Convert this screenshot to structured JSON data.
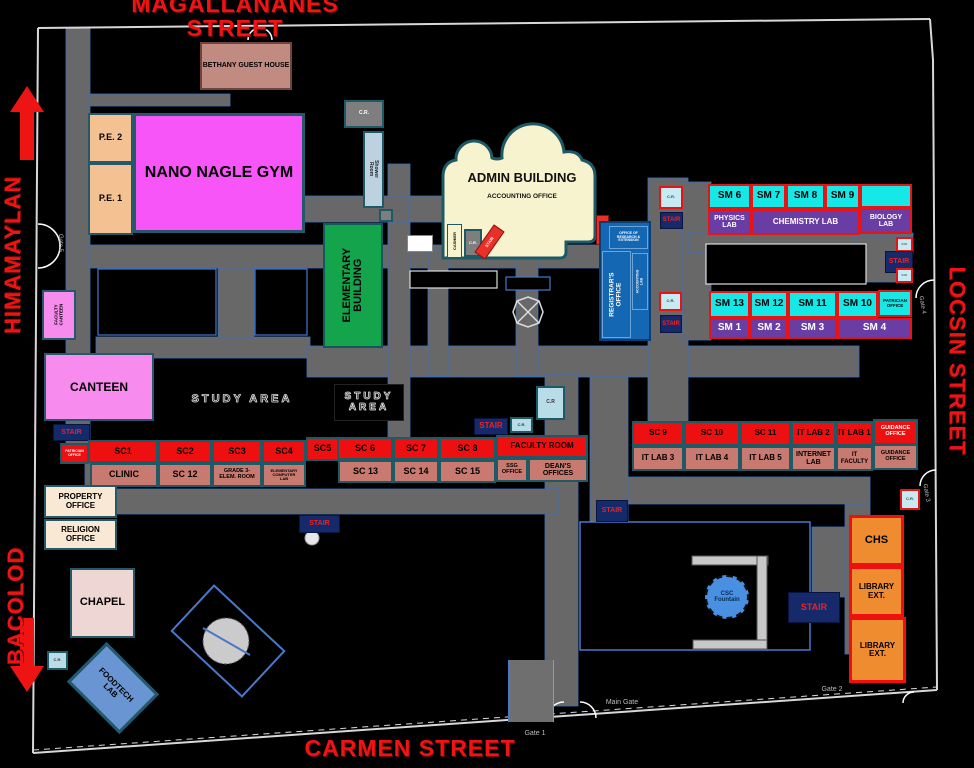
{
  "streets": {
    "top": "MAGALLANANES STREET",
    "left_upper": "HIMAMAYLAN",
    "left_lower": "BACOLOD",
    "right": "LOCSIN STREET",
    "bottom": "CARMEN STREET"
  },
  "colors": {
    "street_text": "#ee1414",
    "room_red": "#ee1010",
    "room_rose": "#c87a70",
    "room_cyan": "#16e8e8",
    "room_purple": "#6a3da5",
    "stair_navy": "#16296b",
    "gym_magenta": "#f855f8",
    "elementary_green": "#14a44c",
    "registrar_blue": "#1467b2",
    "library_orange": "#f08c30",
    "road_gray": "#686868",
    "background": "#000000"
  },
  "rooms": [
    {
      "id": "bethany-guest-house",
      "cls": "brown",
      "x": 200,
      "y": 42,
      "w": 92,
      "h": 48,
      "fs": 7,
      "label": "BETHANY GUEST HOUSE"
    },
    {
      "id": "pe-2",
      "cls": "peach",
      "x": 88,
      "y": 113,
      "w": 45,
      "h": 50,
      "fs": 9,
      "label": "P.E. 2"
    },
    {
      "id": "pe-1",
      "cls": "peach",
      "x": 88,
      "y": 163,
      "w": 45,
      "h": 72,
      "fs": 9,
      "label": "P.E. 1"
    },
    {
      "id": "nano-nagle-gym",
      "cls": "magenta",
      "x": 133,
      "y": 113,
      "w": 172,
      "h": 120,
      "fs": 16,
      "label": "NANO NAGLE GYM"
    },
    {
      "id": "cr-gym",
      "cls": "gray",
      "x": 344,
      "y": 100,
      "w": 40,
      "h": 28,
      "fs": 5,
      "label": "C.R."
    },
    {
      "id": "shower-room",
      "cls": "shower",
      "x": 363,
      "y": 131,
      "w": 21,
      "h": 77,
      "fs": 5,
      "label": "Shower Room",
      "trot": 90
    },
    {
      "id": "utility-box",
      "cls": "gray",
      "x": 379,
      "y": 209,
      "w": 14,
      "h": 13,
      "fs": 3,
      "label": ""
    },
    {
      "id": "elementary-building",
      "cls": "green",
      "x": 323,
      "y": 223,
      "w": 60,
      "h": 125,
      "fs": 11,
      "label": "ELEMENTARY\nBUILDING",
      "trot": -90
    },
    {
      "id": "cashier",
      "cls": "adm2",
      "x": 447,
      "y": 224,
      "w": 15,
      "h": 34,
      "fs": 4,
      "label": "CASHIER",
      "trot": -90
    },
    {
      "id": "cr-admin",
      "cls": "gray",
      "x": 464,
      "y": 229,
      "w": 18,
      "h": 28,
      "fs": 4,
      "label": "C.R."
    },
    {
      "id": "stair-admin",
      "cls": "redstair",
      "x": 483,
      "y": 225,
      "w": 13,
      "h": 34,
      "fs": 4,
      "label": "STAIR",
      "rot": 35,
      "trot": -90
    },
    {
      "id": "white-kiosk",
      "cls": "white",
      "x": 407,
      "y": 235,
      "w": 26,
      "h": 17,
      "fs": 3,
      "label": ""
    },
    {
      "id": "stair-registrar",
      "cls": "redstair",
      "x": 596,
      "y": 215,
      "w": 13,
      "h": 30,
      "fs": 5,
      "label": "STAIR",
      "trot": -90
    },
    {
      "id": "registrar-building",
      "cls": "bluebld",
      "x": 599,
      "y": 221,
      "w": 52,
      "h": 120,
      "fs": 5,
      "label": ""
    },
    {
      "id": "office-research-extension",
      "cls": "blue2",
      "x": 609,
      "y": 226,
      "w": 39,
      "h": 23,
      "fs": 3.5,
      "label": "OFFICE OF\nRESEARCH &\nEXTENSION"
    },
    {
      "id": "registrars-office",
      "cls": "blue2",
      "x": 602,
      "y": 251,
      "w": 29,
      "h": 87,
      "fs": 6.5,
      "label": "REGISTRAR'S\nOFFICE",
      "trot": -90
    },
    {
      "id": "accounting-lab",
      "cls": "blue2",
      "x": 632,
      "y": 253,
      "w": 16,
      "h": 57,
      "fs": 3.5,
      "label": "ACCOUNTING\nLAB",
      "trot": -90
    },
    {
      "id": "cr-sm-upper",
      "cls": "crc",
      "x": 659,
      "y": 186,
      "w": 24,
      "h": 23,
      "fs": 4,
      "label": "C.R."
    },
    {
      "id": "stair-sm-upper",
      "cls": "navy",
      "x": 660,
      "y": 212,
      "w": 23,
      "h": 17,
      "fs": 6,
      "label": "STAIR"
    },
    {
      "id": "sm-6",
      "cls": "cyan",
      "x": 708,
      "y": 184,
      "w": 43,
      "h": 25,
      "fs": 10,
      "label": "SM 6"
    },
    {
      "id": "sm-7",
      "cls": "cyan",
      "x": 751,
      "y": 184,
      "w": 35,
      "h": 25,
      "fs": 10,
      "label": "SM 7"
    },
    {
      "id": "sm-8",
      "cls": "cyan",
      "x": 786,
      "y": 184,
      "w": 39,
      "h": 25,
      "fs": 10,
      "label": "SM 8"
    },
    {
      "id": "sm-9",
      "cls": "cyan",
      "x": 825,
      "y": 184,
      "w": 35,
      "h": 25,
      "fs": 10,
      "label": "SM 9"
    },
    {
      "id": "sm-room-unlabeled",
      "cls": "cyan",
      "x": 860,
      "y": 184,
      "w": 52,
      "h": 24,
      "fs": 8,
      "label": ""
    },
    {
      "id": "physics-lab",
      "cls": "purple",
      "x": 708,
      "y": 209,
      "w": 43,
      "h": 26,
      "fs": 7,
      "label": "PHYSICS\nLAB"
    },
    {
      "id": "chemistry-lab",
      "cls": "purple",
      "x": 751,
      "y": 209,
      "w": 109,
      "h": 26,
      "fs": 8,
      "label": "CHEMISTRY LAB"
    },
    {
      "id": "biology-lab",
      "cls": "purple",
      "x": 860,
      "y": 208,
      "w": 52,
      "h": 26,
      "fs": 7,
      "label": "BIOLOGY\nLAB"
    },
    {
      "id": "cr-right-top",
      "cls": "crc",
      "x": 896,
      "y": 237,
      "w": 17,
      "h": 15,
      "fs": 3,
      "label": "C.R."
    },
    {
      "id": "stair-right",
      "cls": "navy",
      "x": 885,
      "y": 251,
      "w": 28,
      "h": 22,
      "fs": 7,
      "label": "STAIR"
    },
    {
      "id": "cr-right-bottom",
      "cls": "crc",
      "x": 896,
      "y": 268,
      "w": 17,
      "h": 15,
      "fs": 3,
      "label": "C.R."
    },
    {
      "id": "cr-sm-lower",
      "cls": "crc",
      "x": 659,
      "y": 292,
      "w": 23,
      "h": 19,
      "fs": 4,
      "label": "C.R."
    },
    {
      "id": "stair-sm-lower",
      "cls": "navy",
      "x": 660,
      "y": 315,
      "w": 22,
      "h": 18,
      "fs": 6,
      "label": "STAIR"
    },
    {
      "id": "sm-13",
      "cls": "cyan",
      "x": 709,
      "y": 291,
      "w": 41,
      "h": 27,
      "fs": 10,
      "label": "SM 13"
    },
    {
      "id": "sm-12",
      "cls": "cyan",
      "x": 750,
      "y": 291,
      "w": 38,
      "h": 27,
      "fs": 10,
      "label": "SM 12"
    },
    {
      "id": "sm-11",
      "cls": "cyan",
      "x": 788,
      "y": 291,
      "w": 49,
      "h": 27,
      "fs": 10,
      "label": "SM 11"
    },
    {
      "id": "sm-10",
      "cls": "cyan",
      "x": 837,
      "y": 291,
      "w": 41,
      "h": 27,
      "fs": 10,
      "label": "SM 10"
    },
    {
      "id": "patrician-office-sm",
      "cls": "cyan",
      "x": 878,
      "y": 290,
      "w": 34,
      "h": 27,
      "fs": 4.5,
      "label": "PATRICIAN\nOFFICE"
    },
    {
      "id": "sm-1",
      "cls": "purple",
      "x": 709,
      "y": 318,
      "w": 41,
      "h": 21,
      "fs": 10,
      "label": "SM 1"
    },
    {
      "id": "sm-2",
      "cls": "purple",
      "x": 750,
      "y": 318,
      "w": 38,
      "h": 21,
      "fs": 10,
      "label": "SM 2"
    },
    {
      "id": "sm-3",
      "cls": "purple",
      "x": 788,
      "y": 318,
      "w": 49,
      "h": 21,
      "fs": 10,
      "label": "SM 3"
    },
    {
      "id": "sm-4",
      "cls": "purple",
      "x": 837,
      "y": 318,
      "w": 75,
      "h": 21,
      "fs": 10,
      "label": "SM 4"
    },
    {
      "id": "faculty-canteen",
      "cls": "pink",
      "x": 42,
      "y": 290,
      "w": 34,
      "h": 50,
      "fs": 4.5,
      "label": "FACULTY\nCANTEEN",
      "trot": -90
    },
    {
      "id": "canteen",
      "cls": "pink",
      "x": 44,
      "y": 353,
      "w": 110,
      "h": 68,
      "fs": 12,
      "label": "CANTEEN"
    },
    {
      "id": "stair-canteen",
      "cls": "navy",
      "x": 53,
      "y": 424,
      "w": 37,
      "h": 17,
      "fs": 7,
      "label": "STAIR"
    },
    {
      "id": "patrician-office-left",
      "cls": "red wtext",
      "x": 60,
      "y": 443,
      "w": 29,
      "h": 21,
      "fs": 3.5,
      "label": "PATRICIAN\nOFFICE"
    },
    {
      "id": "sc-1",
      "cls": "red",
      "x": 88,
      "y": 440,
      "w": 70,
      "h": 23,
      "fs": 9,
      "label": "SC1"
    },
    {
      "id": "sc-2",
      "cls": "red",
      "x": 158,
      "y": 440,
      "w": 54,
      "h": 23,
      "fs": 9,
      "label": "SC2"
    },
    {
      "id": "sc-3",
      "cls": "red",
      "x": 212,
      "y": 440,
      "w": 50,
      "h": 23,
      "fs": 9,
      "label": "SC3"
    },
    {
      "id": "sc-4",
      "cls": "red",
      "x": 262,
      "y": 440,
      "w": 44,
      "h": 23,
      "fs": 9,
      "label": "SC4"
    },
    {
      "id": "sc-5",
      "cls": "red",
      "x": 306,
      "y": 437,
      "w": 33,
      "h": 24,
      "fs": 9,
      "label": "SC5"
    },
    {
      "id": "sc-6",
      "cls": "red",
      "x": 337,
      "y": 437,
      "w": 56,
      "h": 23,
      "fs": 9,
      "label": "SC 6"
    },
    {
      "id": "sc-7",
      "cls": "red",
      "x": 393,
      "y": 437,
      "w": 46,
      "h": 23,
      "fs": 9,
      "label": "SC 7"
    },
    {
      "id": "sc-8",
      "cls": "red",
      "x": 439,
      "y": 437,
      "w": 57,
      "h": 23,
      "fs": 9,
      "label": "SC 8"
    },
    {
      "id": "faculty-room",
      "cls": "red",
      "x": 496,
      "y": 435,
      "w": 92,
      "h": 23,
      "fs": 8,
      "label": "FACULTY ROOM"
    },
    {
      "id": "clinic",
      "cls": "rose",
      "x": 90,
      "y": 463,
      "w": 68,
      "h": 24,
      "fs": 9,
      "label": "CLINIC"
    },
    {
      "id": "sc-12",
      "cls": "rose",
      "x": 158,
      "y": 463,
      "w": 54,
      "h": 24,
      "fs": 9,
      "label": "SC 12"
    },
    {
      "id": "grade3-elem-room",
      "cls": "rose",
      "x": 212,
      "y": 463,
      "w": 50,
      "h": 24,
      "fs": 5.5,
      "label": "GRADE 3-\nELEM. ROOM"
    },
    {
      "id": "elementary-computer-lab",
      "cls": "rose",
      "x": 262,
      "y": 463,
      "w": 44,
      "h": 24,
      "fs": 4,
      "label": "ELEMENTARY\nCOMPUTER\nLAB"
    },
    {
      "id": "sc-13",
      "cls": "rose",
      "x": 338,
      "y": 460,
      "w": 55,
      "h": 23,
      "fs": 9,
      "label": "SC 13"
    },
    {
      "id": "sc-14",
      "cls": "rose",
      "x": 393,
      "y": 460,
      "w": 46,
      "h": 23,
      "fs": 9,
      "label": "SC 14"
    },
    {
      "id": "sc-15",
      "cls": "rose",
      "x": 439,
      "y": 460,
      "w": 57,
      "h": 23,
      "fs": 9,
      "label": "SC 15"
    },
    {
      "id": "ssg-office",
      "cls": "rose",
      "x": 496,
      "y": 458,
      "w": 32,
      "h": 24,
      "fs": 5.5,
      "label": "SSG\nOFFICE"
    },
    {
      "id": "deans-offices",
      "cls": "rose",
      "x": 528,
      "y": 458,
      "w": 60,
      "h": 24,
      "fs": 7,
      "label": "DEAN'S\nOFFICES"
    },
    {
      "id": "property-office",
      "cls": "cream",
      "x": 44,
      "y": 485,
      "w": 73,
      "h": 33,
      "fs": 8,
      "label": "PROPERTY\nOFFICE"
    },
    {
      "id": "religion-office",
      "cls": "cream",
      "x": 44,
      "y": 519,
      "w": 73,
      "h": 31,
      "fs": 8,
      "label": "RELIGION\nOFFICE"
    },
    {
      "id": "sc-9",
      "cls": "red",
      "x": 632,
      "y": 421,
      "w": 52,
      "h": 25,
      "fs": 8,
      "label": "SC 9"
    },
    {
      "id": "sc-10",
      "cls": "red",
      "x": 684,
      "y": 421,
      "w": 56,
      "h": 25,
      "fs": 8,
      "label": "SC 10"
    },
    {
      "id": "sc-11",
      "cls": "red",
      "x": 740,
      "y": 421,
      "w": 51,
      "h": 25,
      "fs": 8,
      "label": "SC 11"
    },
    {
      "id": "it-lab-2",
      "cls": "red",
      "x": 791,
      "y": 421,
      "w": 45,
      "h": 25,
      "fs": 8,
      "label": "IT LAB 2"
    },
    {
      "id": "it-lab-1",
      "cls": "red",
      "x": 836,
      "y": 421,
      "w": 37,
      "h": 25,
      "fs": 8,
      "label": "IT LAB 1"
    },
    {
      "id": "guidance-office-upper",
      "cls": "red wtext",
      "x": 873,
      "y": 419,
      "w": 45,
      "h": 26,
      "fs": 5.5,
      "label": "GUIDANCE\nOFFICE"
    },
    {
      "id": "it-lab-3",
      "cls": "rose",
      "x": 632,
      "y": 446,
      "w": 52,
      "h": 25,
      "fs": 8,
      "label": "IT LAB 3"
    },
    {
      "id": "it-lab-4",
      "cls": "rose",
      "x": 684,
      "y": 446,
      "w": 56,
      "h": 25,
      "fs": 8,
      "label": "IT LAB 4"
    },
    {
      "id": "it-lab-5",
      "cls": "rose",
      "x": 740,
      "y": 446,
      "w": 51,
      "h": 25,
      "fs": 8,
      "label": "IT LAB 5"
    },
    {
      "id": "internet-lab",
      "cls": "rose",
      "x": 791,
      "y": 446,
      "w": 45,
      "h": 25,
      "fs": 7,
      "label": "INTERNET\nLAB"
    },
    {
      "id": "it-faculty",
      "cls": "rose",
      "x": 836,
      "y": 446,
      "w": 37,
      "h": 25,
      "fs": 6,
      "label": "IT\nFACULTY"
    },
    {
      "id": "guidance-office-lower",
      "cls": "rose",
      "x": 873,
      "y": 444,
      "w": 45,
      "h": 26,
      "fs": 5.5,
      "label": "GUIDANCE\nOFFICE"
    },
    {
      "id": "cr-gate3",
      "cls": "crc",
      "x": 900,
      "y": 489,
      "w": 20,
      "h": 21,
      "fs": 4,
      "label": "C.R."
    },
    {
      "id": "cr-faculty-big",
      "cls": "crc2",
      "x": 536,
      "y": 386,
      "w": 29,
      "h": 34,
      "fs": 5,
      "label": "C.R"
    },
    {
      "id": "cr-faculty-small",
      "cls": "crc2",
      "x": 510,
      "y": 417,
      "w": 23,
      "h": 16,
      "fs": 4,
      "label": "C.R."
    },
    {
      "id": "stair-faculty",
      "cls": "navy",
      "x": 474,
      "y": 418,
      "w": 34,
      "h": 17,
      "fs": 8,
      "label": "STAIR"
    },
    {
      "id": "stair-main-road",
      "cls": "navy",
      "x": 596,
      "y": 500,
      "w": 32,
      "h": 22,
      "fs": 7,
      "label": "STAIR"
    },
    {
      "id": "stair-sc-road",
      "cls": "navy",
      "x": 299,
      "y": 515,
      "w": 41,
      "h": 18,
      "fs": 7,
      "label": "STAIR"
    },
    {
      "id": "chapel",
      "cls": "chapelc",
      "x": 70,
      "y": 568,
      "w": 65,
      "h": 70,
      "fs": 11,
      "label": "CHAPEL"
    },
    {
      "id": "cr-chapel",
      "cls": "crc2",
      "x": 47,
      "y": 651,
      "w": 21,
      "h": 19,
      "fs": 4,
      "label": "C.R."
    },
    {
      "id": "foodtech-lab",
      "cls": "fblue",
      "x": 76,
      "y": 660,
      "w": 74,
      "h": 56,
      "fs": 8,
      "label": "FOODTECH\nLAB",
      "rot": 45
    },
    {
      "id": "csc-fountain",
      "cls": "fountain",
      "x": 705,
      "y": 575,
      "w": 44,
      "h": 44,
      "fs": 6,
      "label": "CSC\nFountain",
      "round": true
    },
    {
      "id": "stair-csc",
      "cls": "navy",
      "x": 788,
      "y": 592,
      "w": 52,
      "h": 31,
      "fs": 9,
      "label": "STAIR"
    },
    {
      "id": "chs",
      "cls": "orange",
      "x": 849,
      "y": 515,
      "w": 55,
      "h": 51,
      "fs": 11,
      "label": "CHS"
    },
    {
      "id": "library-ext-1",
      "cls": "orange",
      "x": 849,
      "y": 566,
      "w": 55,
      "h": 51,
      "fs": 8,
      "label": "LIBRARY\nEXT."
    },
    {
      "id": "library-ext-2",
      "cls": "orange",
      "x": 849,
      "y": 617,
      "w": 57,
      "h": 66,
      "fs": 8,
      "label": "LIBRARY\nEXT."
    },
    {
      "id": "gatehouse",
      "cls": "gray2",
      "x": 508,
      "y": 660,
      "w": 46,
      "h": 62,
      "fs": 3,
      "label": ""
    }
  ],
  "texts": [
    {
      "id": "street-magallananes",
      "cls": "street",
      "x": 90,
      "y": 2,
      "w": 290,
      "h": 28,
      "fs": 23,
      "label": "MAGALLANANES STREET"
    },
    {
      "id": "street-himamaylan",
      "cls": "street",
      "x": -70,
      "y": 242,
      "w": 166,
      "h": 26,
      "fs": 22,
      "rot": -90,
      "label": "HIMAMAYLAN"
    },
    {
      "id": "street-bacolod",
      "cls": "street",
      "x": -39,
      "y": 593,
      "w": 110,
      "h": 26,
      "fs": 22,
      "rot": -90,
      "label": "BACOLOD"
    },
    {
      "id": "street-locsin",
      "cls": "street",
      "x": 857,
      "y": 346,
      "w": 200,
      "h": 30,
      "fs": 22,
      "rot": 90,
      "label": "LOCSIN STREET"
    },
    {
      "id": "street-carmen",
      "cls": "street",
      "x": 295,
      "y": 733,
      "w": 230,
      "h": 30,
      "fs": 23,
      "label": "CARMEN STREET"
    },
    {
      "id": "admin-building-title",
      "cls": "blab",
      "x": 448,
      "y": 170,
      "w": 148,
      "h": 16,
      "fs": 13,
      "label": "ADMIN BUILDING"
    },
    {
      "id": "admin-accounting-office",
      "cls": "blab",
      "x": 448,
      "y": 192,
      "w": 148,
      "h": 10,
      "fs": 6.5,
      "label": "ACCOUNTING OFFICE"
    },
    {
      "id": "study-area-1",
      "cls": "studytxt",
      "x": 186,
      "y": 390,
      "w": 112,
      "h": 20,
      "fs": 11,
      "label": "STUDY AREA"
    },
    {
      "id": "study-area-2",
      "cls": "studytxt box2",
      "x": 334,
      "y": 384,
      "w": 68,
      "h": 35,
      "fs": 10,
      "label": "STUDY\nAREA"
    },
    {
      "id": "gate-5-label",
      "cls": "gatelbl",
      "x": 40,
      "y": 238,
      "w": 40,
      "h": 10,
      "fs": 6,
      "rot": 90,
      "label": "Gate 5"
    },
    {
      "id": "gate-4-label",
      "cls": "gatelbl",
      "x": 902,
      "y": 300,
      "w": 40,
      "h": 10,
      "fs": 6,
      "rot": 80,
      "label": "Gate 4"
    },
    {
      "id": "gate-3-label",
      "cls": "gatelbl",
      "x": 906,
      "y": 488,
      "w": 40,
      "h": 10,
      "fs": 6,
      "rot": 80,
      "label": "Gate 3"
    },
    {
      "id": "gate-2-label",
      "cls": "gatelbl",
      "x": 812,
      "y": 685,
      "w": 40,
      "h": 10,
      "fs": 7,
      "label": "Gate 2"
    },
    {
      "id": "gate-1-label",
      "cls": "gatelbl",
      "x": 515,
      "y": 729,
      "w": 40,
      "h": 10,
      "fs": 7,
      "label": "Gate 1"
    },
    {
      "id": "main-gate-label",
      "cls": "gatelbl",
      "x": 596,
      "y": 698,
      "w": 52,
      "h": 10,
      "fs": 7,
      "label": "Main Gate"
    }
  ]
}
